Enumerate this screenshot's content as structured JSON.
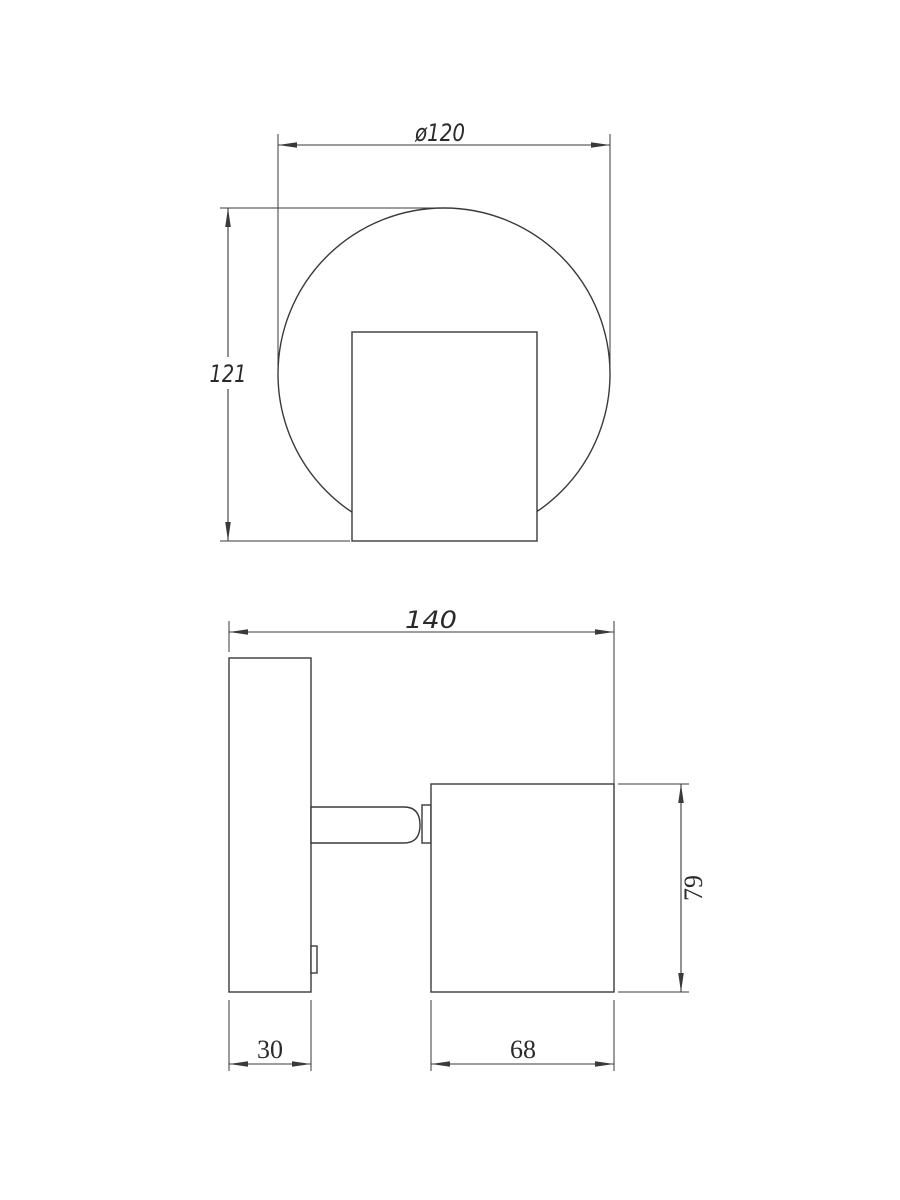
{
  "dimensions": {
    "diameter": "ø120",
    "overall_height": "121",
    "overall_width": "140",
    "head_height": "79",
    "plate_depth": "30",
    "head_depth": "68"
  },
  "colors": {
    "line": "#3a3a3a",
    "text": "#2a2a2a",
    "background": "#ffffff"
  }
}
